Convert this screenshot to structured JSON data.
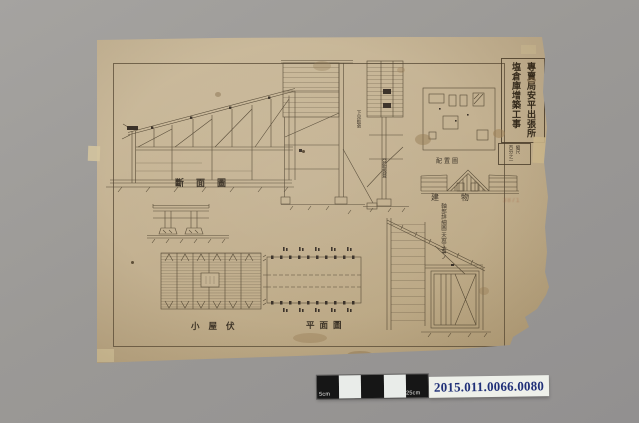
{
  "photo": {
    "background": "#9b9996",
    "scale_bar": {
      "label_left": "5cm",
      "label_right": "25cm",
      "segment_pattern": [
        "black",
        "white",
        "black",
        "white",
        "black"
      ],
      "dark_color": "#161616",
      "light_color": "#e9ece9"
    },
    "accession": {
      "number": "2015.011.0066.0080",
      "text_color": "#203078"
    }
  },
  "sheet": {
    "paper_color": "#c4b292",
    "ink_color": "#564a36",
    "title": {
      "column1": "專賣局安平出張所",
      "column2": "塩倉庫增築工事"
    },
    "scale_note": {
      "line1": "縮尺",
      "line2": "百分之一"
    },
    "labels": {
      "section": "斷面圖",
      "site_plan": "配置圖",
      "elevation": "建物",
      "roof_framing_plan": "小屋伏",
      "floor_plan": "平面圖"
    },
    "annotations": {
      "detail_title_line1": "天窓工事ノ",
      "detail_title_line2": "軸部詳細圖",
      "material_note_left": "下見板張",
      "material_note_right": "亞鉛板葺",
      "pencil_note": "3871"
    }
  }
}
